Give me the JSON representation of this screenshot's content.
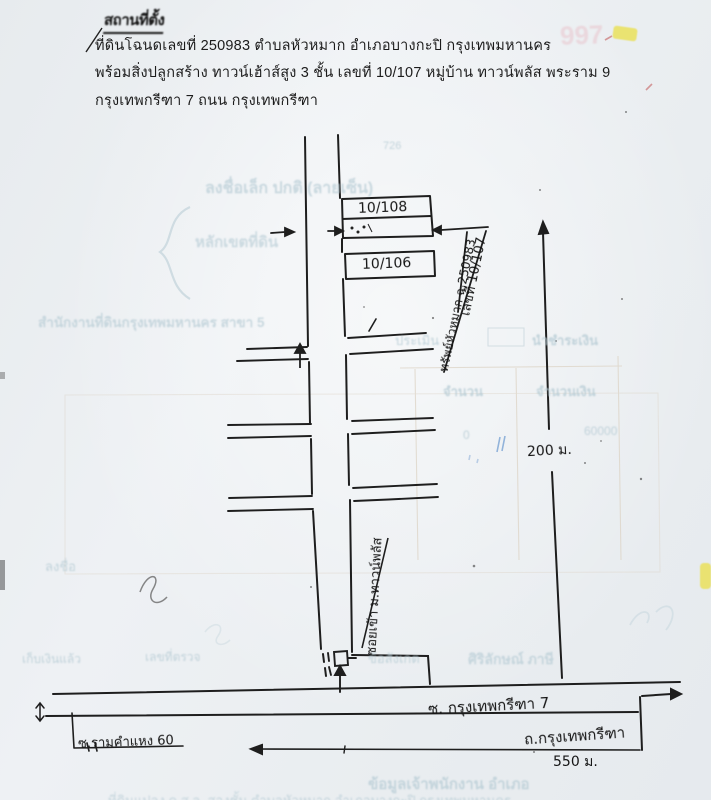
{
  "document": {
    "title": "สถานที่ตั้ง",
    "header_lines": [
      "ที่ดินโฉนดเลขที่ 250983  ตำบลหัวหมาก   อำเภอบางกะปิ  กรุงเทพมหานคร",
      "พร้อมสิ่งปลูกสร้าง ทาวน์เฮ้าส์สูง 3 ชั้น เลขที่ 10/107  หมู่บ้าน ทาวน์พลัส พระราม 9",
      "กรุงเทพกรีฑา 7   ถนน กรุงเทพกรีฑา"
    ]
  },
  "map": {
    "buildings": {
      "b108": "10/108",
      "b106": "10/106"
    },
    "callouts": {
      "house_no": "เลขที่ 10/107",
      "deed": "ทรัพย์หัวหมาก ฉ.250983",
      "village_soi": "ซอยเข้า ม.ทาวน์พลัส"
    },
    "distances": {
      "d200": "200 ม.",
      "d550": "550 ม."
    },
    "roads": {
      "soi_kreetha7": "ซ. กรุงเทพกรีฑา 7",
      "thanon_kreetha": "ถ.กรุงเทพกรีฑา",
      "soi_ram60": "ซ.รามคำแหง 60"
    }
  },
  "bleed_through": {
    "num_726": "726",
    "sign_row": "ลงชื่อเล็ก ปกติ  (ลายเซ็น)",
    "land_row": "หลักเขตที่ดิน",
    "office_row": "สำนักงานที่ดินกรุงเทพมหานคร สาขา 5",
    "assess": "ประเมิน",
    "pay": "นำชำระเงิน",
    "qty": "จำนวน",
    "amount": "จำนวนเงิน",
    "amt_60000": "60000",
    "amt_0": "0",
    "sign2": "ลงชื่อ",
    "collected": "เก็บเงินแล้ว",
    "check_no": "เลขที่ตรวจ",
    "remark": "ข้อสังเกต",
    "name_row": "ศิริลักษณ์ ภาษี",
    "pink_num": "997",
    "bottom_bold": "ข้อมูลเจ้าพนักงาน อำเภอ",
    "bottom_line": "ที่ดินแปลง ค.ส.ล. สองชั้น ตำบลหัวหมาก อำเภอบางกะปิ  กรุงเทพมหานคร"
  },
  "colors": {
    "ink": "#1e1e1e",
    "paper": "#edf0f3",
    "bleed_teal": "#b9ccd4",
    "table_tan": "#d9cfc0",
    "blue_mark": "#7ba3d4",
    "pencil": "#6a6a6a",
    "highlight_yellow": "#eae163",
    "pink": "#e8b4be"
  }
}
